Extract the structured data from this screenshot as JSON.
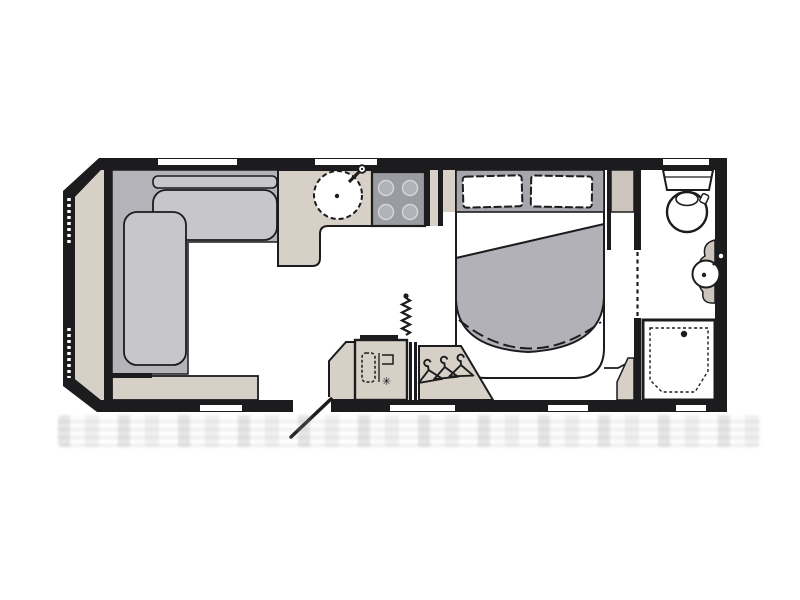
{
  "document": {
    "title": "Caravan floor plan",
    "kind": "scanned layout diagram"
  },
  "palette": {
    "wall": "#1c1c1e",
    "floor": "#ffffff",
    "beige": "#d7d0c7",
    "beigeDark": "#cbc5bd",
    "sofaBase": "#b3b3b9",
    "cushion": "#c6c6cb",
    "headboard": "#a6a6ac",
    "duvet": "#b1b1b7",
    "stove": "#9b9ca2",
    "burner": "#b2b3b9",
    "noise": "#c7c7c7"
  },
  "rooms": [
    {
      "name": "front-lounge",
      "features": [
        "l-shaped-sofa",
        "front-locker-shelf",
        "side-shelf"
      ]
    },
    {
      "name": "kitchen",
      "features": [
        "round-sink",
        "tap",
        "four-burner-hob",
        "l-shaped-worktop"
      ]
    },
    {
      "name": "bedroom",
      "features": [
        "island-bed",
        "two-pillows",
        "duvet",
        "bedside-cabinet"
      ]
    },
    {
      "name": "mid-storage",
      "features": [
        "fridge",
        "wardrobe-with-3-hangers",
        "pleated-screen"
      ]
    },
    {
      "name": "washroom",
      "features": [
        "toilet",
        "washbasin",
        "shower-tray",
        "sliding-door-track"
      ]
    }
  ],
  "door": {
    "type": "entry-door",
    "state": "open"
  },
  "icons": {
    "snowflake": "✳"
  }
}
